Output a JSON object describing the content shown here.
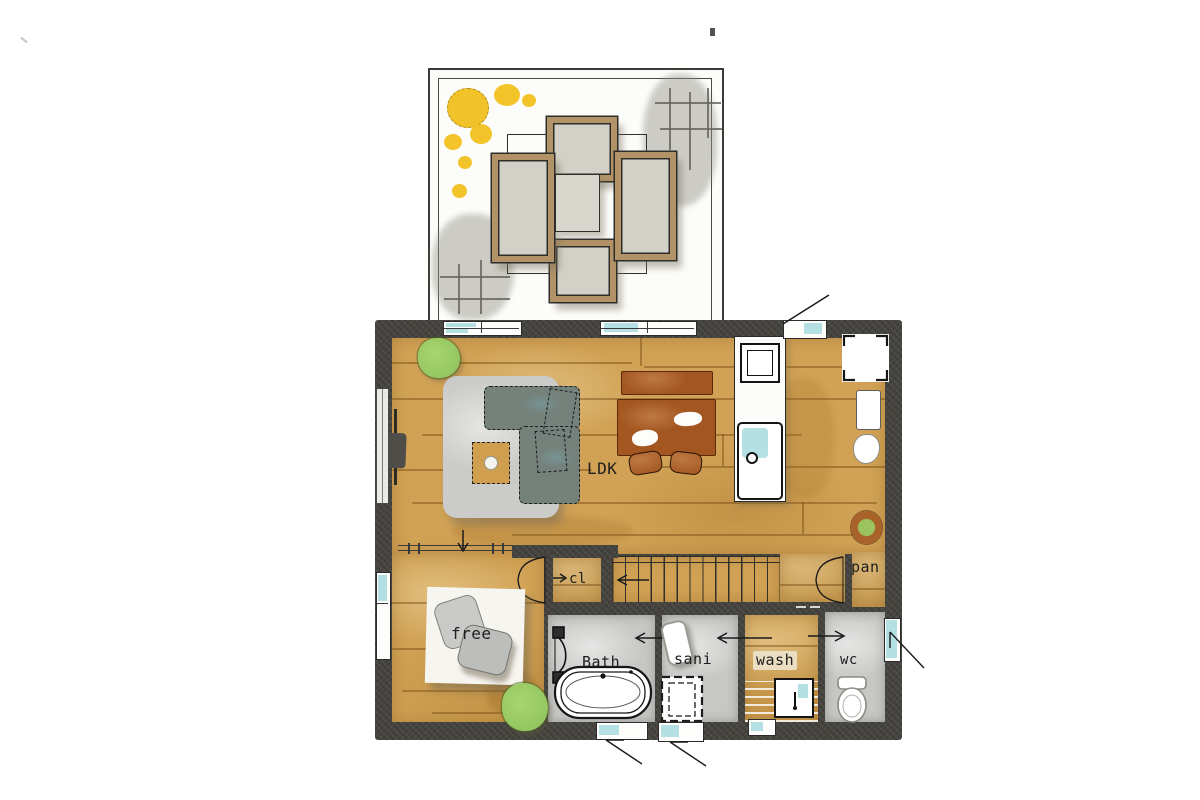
{
  "labels": {
    "ldk": "LDK",
    "closet": "cl",
    "pantry": "pan",
    "free_room": "free",
    "bath": "Bath",
    "sanitary": "sani",
    "wash": "wash",
    "toilet": "wc"
  },
  "colors": {
    "wall": "#45433e",
    "wood_floor": "#d1a255",
    "tile_floor": "#c7c7c5",
    "rug_gray": "#cbcbc9",
    "rug_white": "#f7f5f0",
    "sofa": "#75827c",
    "dining_wood": "#a3561f",
    "deck_seat_frame": "#b29367",
    "deck_seat_cushion": "#d3d0c7",
    "plant_green": "#8cc15c",
    "flower_yellow": "#f2c11d",
    "window_blue": "#a8dade",
    "planter_ring": "#a9622a"
  }
}
